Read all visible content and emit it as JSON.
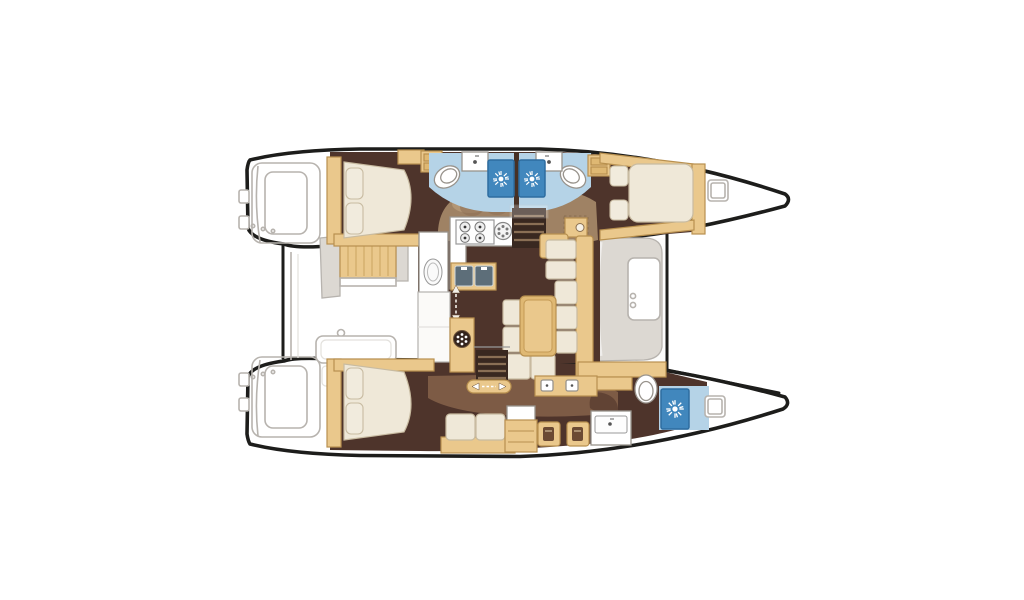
{
  "image": {
    "type": "floor-plan-diagram",
    "subject": "Catamaran interior layout, top-down view",
    "background": "#ffffff"
  },
  "palette": {
    "hull_outline": "#1d1d1b",
    "exterior_line": "#b7b3ae",
    "exterior_fill": "#dcd8d2",
    "floor_dark": "#4e342b",
    "floor_mid": "#7d5b45",
    "floor_overlay": "#a38767",
    "overlay_light": "#b89b79",
    "wood": "#eac88c",
    "wood_dark": "#dfb873",
    "wood_border": "#b8904f",
    "upholstery": "#efe8d8",
    "upholstery_border": "#c8bba1",
    "pillow": "#f1ebdd",
    "bath_floor": "#b5d3e7",
    "shower_blue": "#4187bd",
    "shower_border": "#2e6da0",
    "fixture_stroke": "#98938c",
    "sink_basin": "#5d6e79",
    "step_line": "#8a6f55",
    "stair_well": "#392820"
  },
  "fixtures": {
    "double_beds": 3,
    "bathrooms": 3,
    "shower_stalls": 3,
    "toilets": 3,
    "bathroom_sinks": 3,
    "galley_sink_basins": 2,
    "stove_burners": 4,
    "stairways_to_hulls": 2,
    "sliding_doors": 2,
    "deck_hatches": 2,
    "cockpit_benches": 2,
    "stern_platforms": 2,
    "vanity_stools": 2,
    "dining_table": 1,
    "salon_cushions": 9
  },
  "icons": [
    "shower-head-sunburst-icon",
    "stove-burner-icon",
    "sink-basin-icon",
    "toilet-icon",
    "drawer-unit-icon",
    "sliding-door-arrows-icon",
    "stair-steps-icon",
    "deck-hatch-icon",
    "speaker-grille-icon"
  ]
}
